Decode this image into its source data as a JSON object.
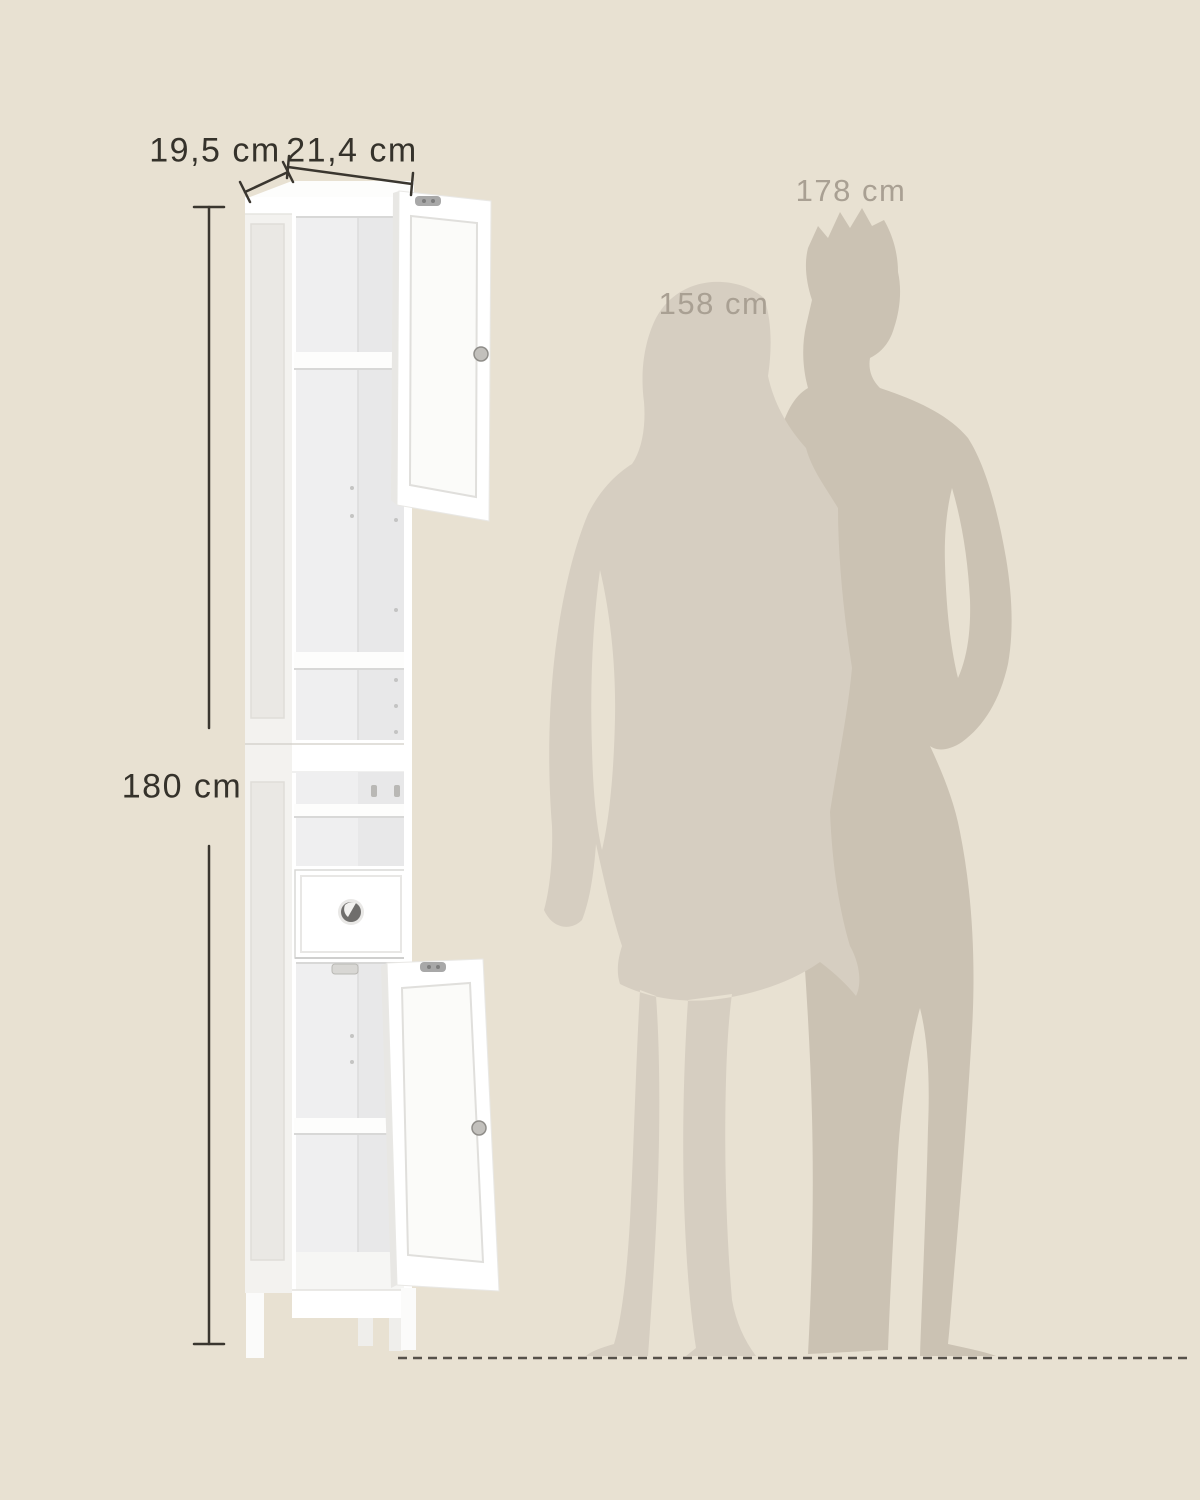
{
  "scene": {
    "type": "product-dimension-illustration",
    "background_color": "#e8e1d2",
    "dimensions": {
      "depth_label": "19,5 cm",
      "width_label": "21,4 cm",
      "height_label": "180 cm"
    },
    "scale_references": {
      "man_height_label": "178 cm",
      "woman_height_label": "158 cm"
    },
    "colors": {
      "dimension_line": "#3a362f",
      "dimension_text": "#35322b",
      "reference_text": "#a9a093",
      "man_silhouette": "#cbc2b3",
      "woman_silhouette": "#d6cec1",
      "cabinet_body": "#ffffff",
      "cabinet_side_panel": "#f3f2ef",
      "cabinet_recessed_panel": "#eae8e4",
      "cabinet_interior": "#efeff0",
      "cabinet_interior_wall": "#e8e8e9",
      "shelf_edge": "#fdfdfc",
      "drawer_knob": "#6f6e6c",
      "hinge_metal": "#a8a8a8",
      "ground_line": "#56514a"
    }
  }
}
